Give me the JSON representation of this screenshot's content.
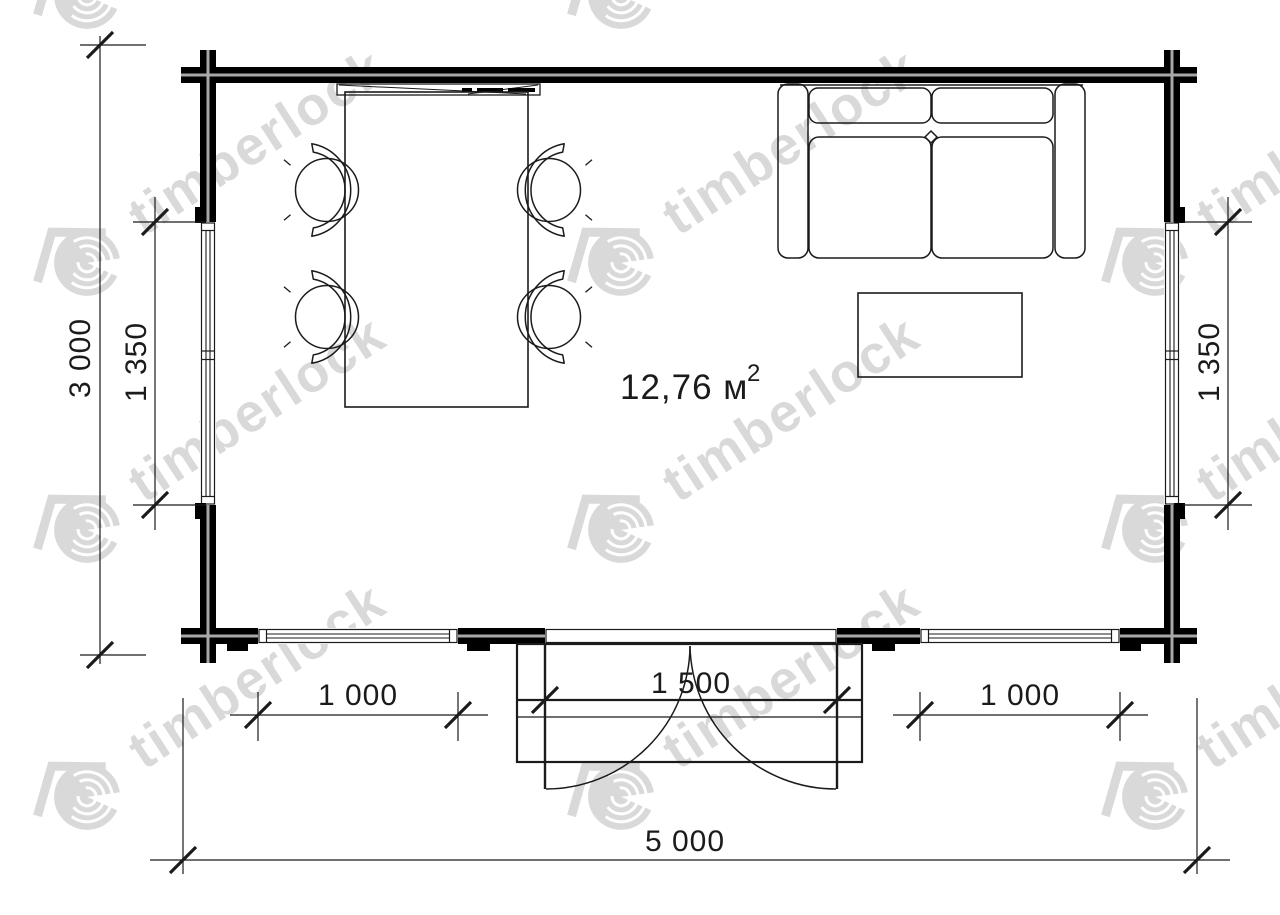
{
  "document": {
    "type": "floor-plan",
    "brand": "timberlock"
  },
  "watermark": {
    "text": "timberlock",
    "icon": "timberlock-log-roof-logo",
    "color": "#d9d9d9"
  },
  "area_label": {
    "value": "12,76 м",
    "superscript": "2"
  },
  "dimensions": {
    "overall_width": "5 000",
    "overall_depth": "3 000",
    "left_wall_window": "1 350",
    "right_wall_window": "1 350",
    "front_left_window": "1 000",
    "front_door": "1 500",
    "front_right_window": "1 000"
  },
  "colors": {
    "wall": "#000000",
    "wall_core_line": "#a8a8a8",
    "line": "#1b1b1b",
    "watermark": "#d9d9d9"
  },
  "furniture": [
    "dining-table",
    "chair x4",
    "sofa",
    "coffee-table",
    "wall-console"
  ],
  "openings": [
    "left-window",
    "right-window",
    "front-left-window",
    "front-right-window",
    "double-door"
  ],
  "structures": [
    "log-walls",
    "porch-steps"
  ]
}
